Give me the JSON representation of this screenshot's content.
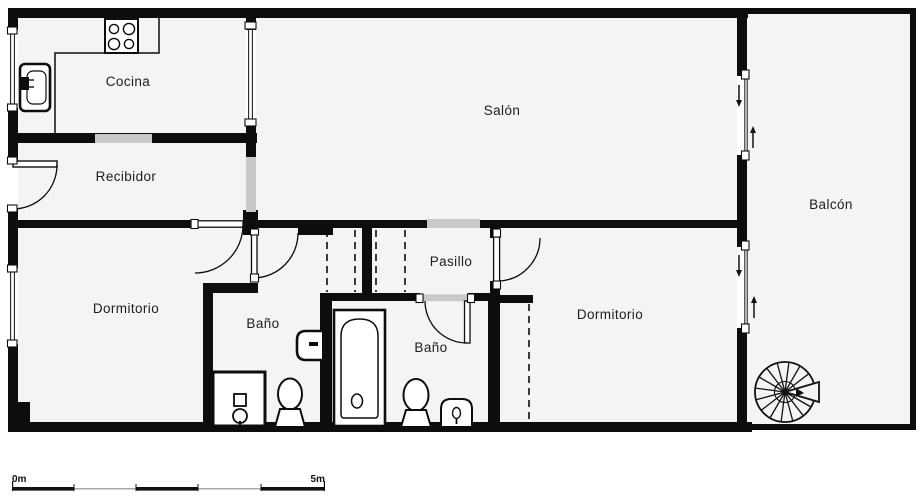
{
  "plan": {
    "type": "floor-plan",
    "rooms": [
      {
        "id": "cocina",
        "label": "Cocina"
      },
      {
        "id": "recibidor",
        "label": "Recibidor"
      },
      {
        "id": "salon",
        "label": "Salón"
      },
      {
        "id": "balcon",
        "label": "Balcón"
      },
      {
        "id": "dormitorio-izq",
        "label": "Dormitorio"
      },
      {
        "id": "bano-1",
        "label": "Baño"
      },
      {
        "id": "pasillo",
        "label": "Pasillo"
      },
      {
        "id": "bano-2",
        "label": "Baño"
      },
      {
        "id": "dormitorio-der",
        "label": "Dormitorio"
      }
    ],
    "fixtures": [
      "stove-icon",
      "kitchen-sink-icon",
      "kitchen-counter",
      "shower-icon",
      "toilet-icon",
      "washbasin-icon",
      "bathtub-icon",
      "bidet-icon",
      "spiral-staircase-icon",
      "sliding-door-arrow-icons",
      "door-swing-arcs",
      "wardrobe-dashed-fronts"
    ],
    "scale_bar": {
      "start_label": "0m",
      "end_label": "5m"
    },
    "colors": {
      "wall": "#0d0d0d",
      "floor": "#f4f4f4",
      "opening": "#c9c9c9",
      "background": "#ffffff",
      "text": "#1d1d1d"
    }
  }
}
